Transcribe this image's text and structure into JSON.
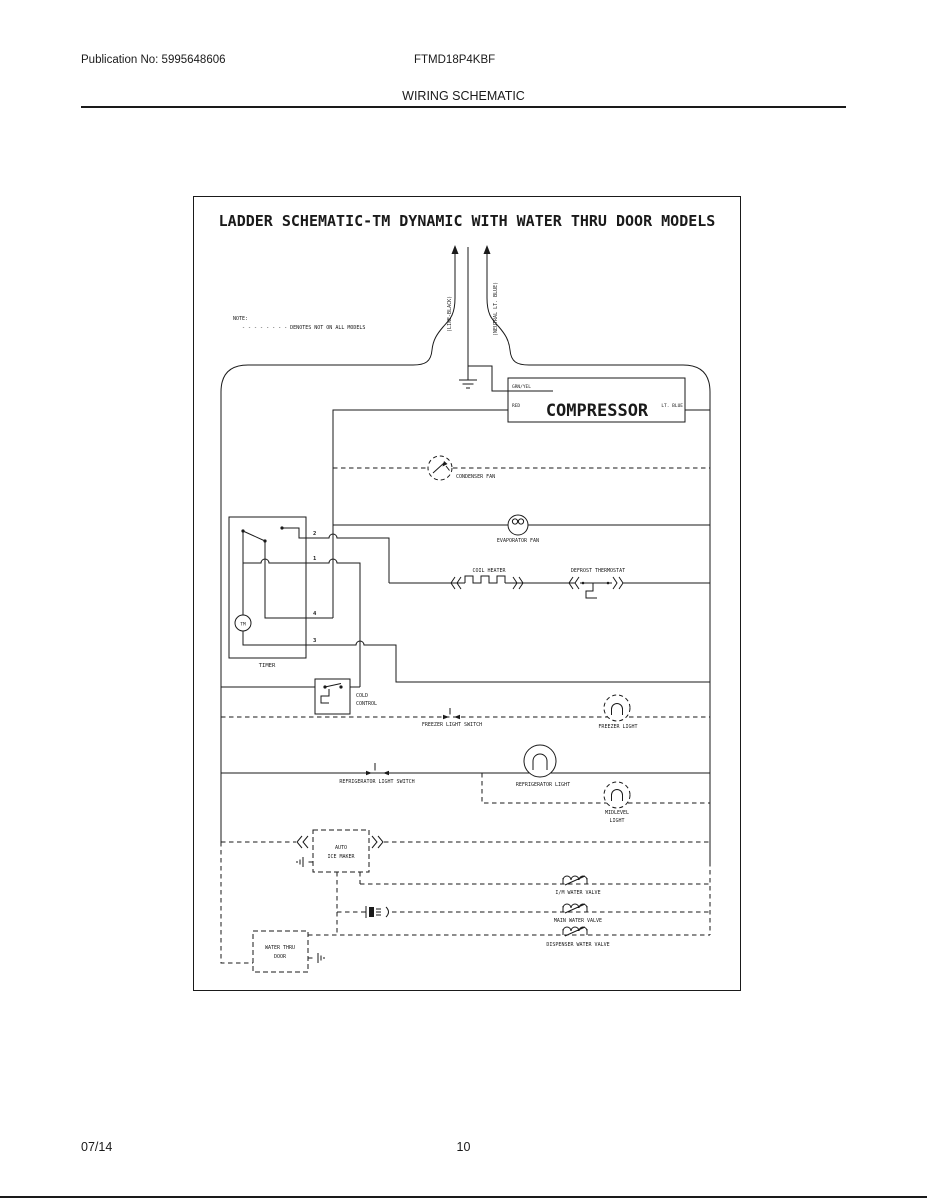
{
  "page": {
    "publication": "Publication No: 5995648606",
    "model": "FTMD18P4KBF",
    "section": "WIRING SCHEMATIC",
    "footer_date": "07/14",
    "footer_page": "10"
  },
  "schematic": {
    "title": "LADDER SCHEMATIC-TM DYNAMIC WITH WATER THRU DOOR MODELS",
    "note_label": "NOTE:",
    "note_text": "- - - - - - - -  DENOTES NOT ON ALL MODELS",
    "line_feed": "(LINE-BLACK)",
    "neutral_feed": "(NEUTRAL LT. BLUE)",
    "compressor": "COMPRESSOR",
    "wire_grn_yel": "GRN/YEL",
    "wire_red": "RED",
    "wire_lt_blue": "LT. BLUE",
    "condenser_fan": "CONDENSER FAN",
    "evaporator_fan": "EVAPORATOR FAN",
    "coil_heater": "COIL HEATER",
    "defrost_thermostat": "DEFROST THERMOSTAT",
    "timer": "TIMER",
    "timer_motor": "TM",
    "t1": "1",
    "t2": "2",
    "t3": "3",
    "t4": "4",
    "cold_control_1": "COLD",
    "cold_control_2": "CONTROL",
    "freezer_light_switch": "FREEZER LIGHT SWITCH",
    "freezer_light": "FREEZER LIGHT",
    "refrigerator_light_switch": "REFRIGERATOR LIGHT SWITCH",
    "refrigerator_light": "REFRIGERATOR LIGHT",
    "midlevel_1": "MIDLEVEL",
    "midlevel_2": "LIGHT",
    "ice_maker_1": "AUTO",
    "ice_maker_2": "ICE MAKER",
    "im_valve": "I/M WATER VALVE",
    "main_valve": "MAIN WATER VALVE",
    "dispenser_valve": "DISPENSER WATER VALVE",
    "water_thru_door_1": "WATER THRU",
    "water_thru_door_2": "DOOR"
  },
  "colors": {
    "ink": "#1a1a1a",
    "paper": "#ffffff"
  }
}
